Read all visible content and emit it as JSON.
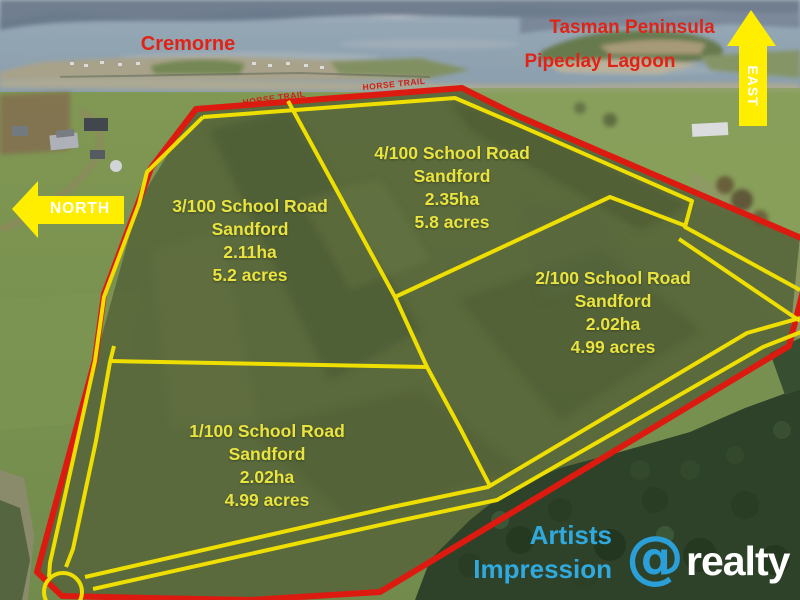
{
  "colors": {
    "boundary_red": "#ec1c12",
    "boundary_yellow": "#ffee00",
    "lot_text_yellow": "#e9e43f",
    "place_red": "#e02317",
    "trail_red": "#cf2014",
    "impression_blue": "#2FA9DE",
    "compass_text_white": "#ffffff",
    "brand_blue": "#2B9FD8",
    "brand_white": "#ffffff"
  },
  "places": {
    "cremorne": "Cremorne",
    "tasman_peninsula": "Tasman Peninsula",
    "pipeclay_lagoon": "Pipeclay Lagoon"
  },
  "compass": {
    "north": "NORTH",
    "east": "EAST"
  },
  "trail": {
    "left": "HORSE TRAIL",
    "right": "HORSE TRAIL"
  },
  "lots": [
    {
      "lot": "1",
      "address": "1/100 School Road",
      "suburb": "Sandford",
      "area_ha": "2.02ha",
      "area_acres": "4.99 acres"
    },
    {
      "lot": "2",
      "address": "2/100 School Road",
      "suburb": "Sandford",
      "area_ha": "2.02ha",
      "area_acres": "4.99 acres"
    },
    {
      "lot": "3",
      "address": "3/100 School Road",
      "suburb": "Sandford",
      "area_ha": "2.11ha",
      "area_acres": "5.2 acres"
    },
    {
      "lot": "4",
      "address": "4/100 School Road",
      "suburb": "Sandford",
      "area_ha": "2.35ha",
      "area_acres": "5.8 acres"
    }
  ],
  "watermark": {
    "line1": "Artists",
    "line2": "Impression"
  },
  "brand": {
    "symbol": "@",
    "name": "realty"
  }
}
